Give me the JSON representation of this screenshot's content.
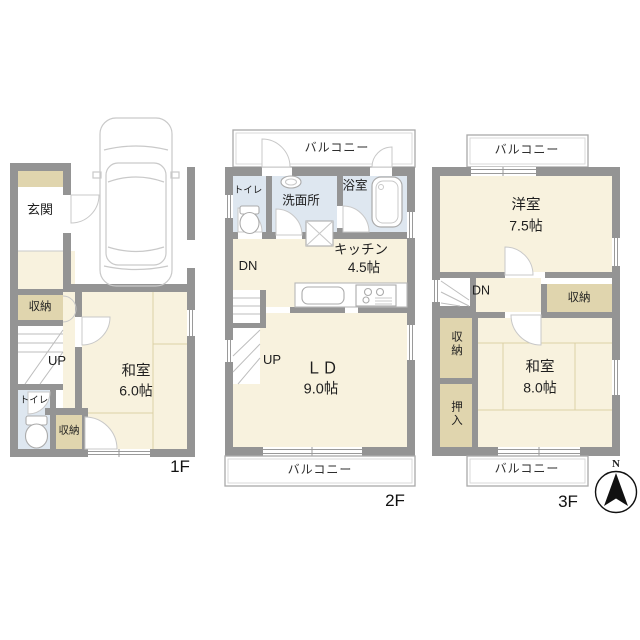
{
  "title": "3-story house floor plan",
  "palette": {
    "room_cream": "#F8F2DE",
    "storage_beige": "#E0D5AE",
    "wet_area_blue": "#DEE7F0",
    "wall_gray": "#949494",
    "tatami_line": "#DCD1A6",
    "fixture_outline": "#B9B9B9",
    "door_arc": "#C8C8C8",
    "text": "#1E1E1E"
  },
  "floor1": {
    "floor_label": "1F",
    "entrance": "玄関",
    "storage_upper": "収納",
    "stairs_up_label": "UP",
    "toilet": "トイレ",
    "storage_lower": "収納",
    "japanese_room": "和室",
    "japanese_room_size": "6.0帖"
  },
  "floor2": {
    "floor_label": "2F",
    "balcony_top": "バルコニー",
    "toilet": "トイレ",
    "washroom": "洗面所",
    "bathroom": "浴室",
    "kitchen": "キッチン",
    "kitchen_size": "4.5帖",
    "stairs_down_label": "DN",
    "stairs_up_label": "UP",
    "living_dining": "ＬＤ",
    "living_dining_size": "9.0帖",
    "balcony_bottom": "バルコニー"
  },
  "floor3": {
    "floor_label": "3F",
    "balcony_top": "バルコニー",
    "western_room": "洋室",
    "western_room_size": "7.5帖",
    "stairs_down_label": "DN",
    "storage_hall": "収納",
    "storage_side": "収納",
    "closet": "押入",
    "japanese_room": "和室",
    "japanese_room_size": "8.0帖",
    "balcony_bottom": "バルコニー"
  },
  "compass": {
    "north_label": "N"
  }
}
